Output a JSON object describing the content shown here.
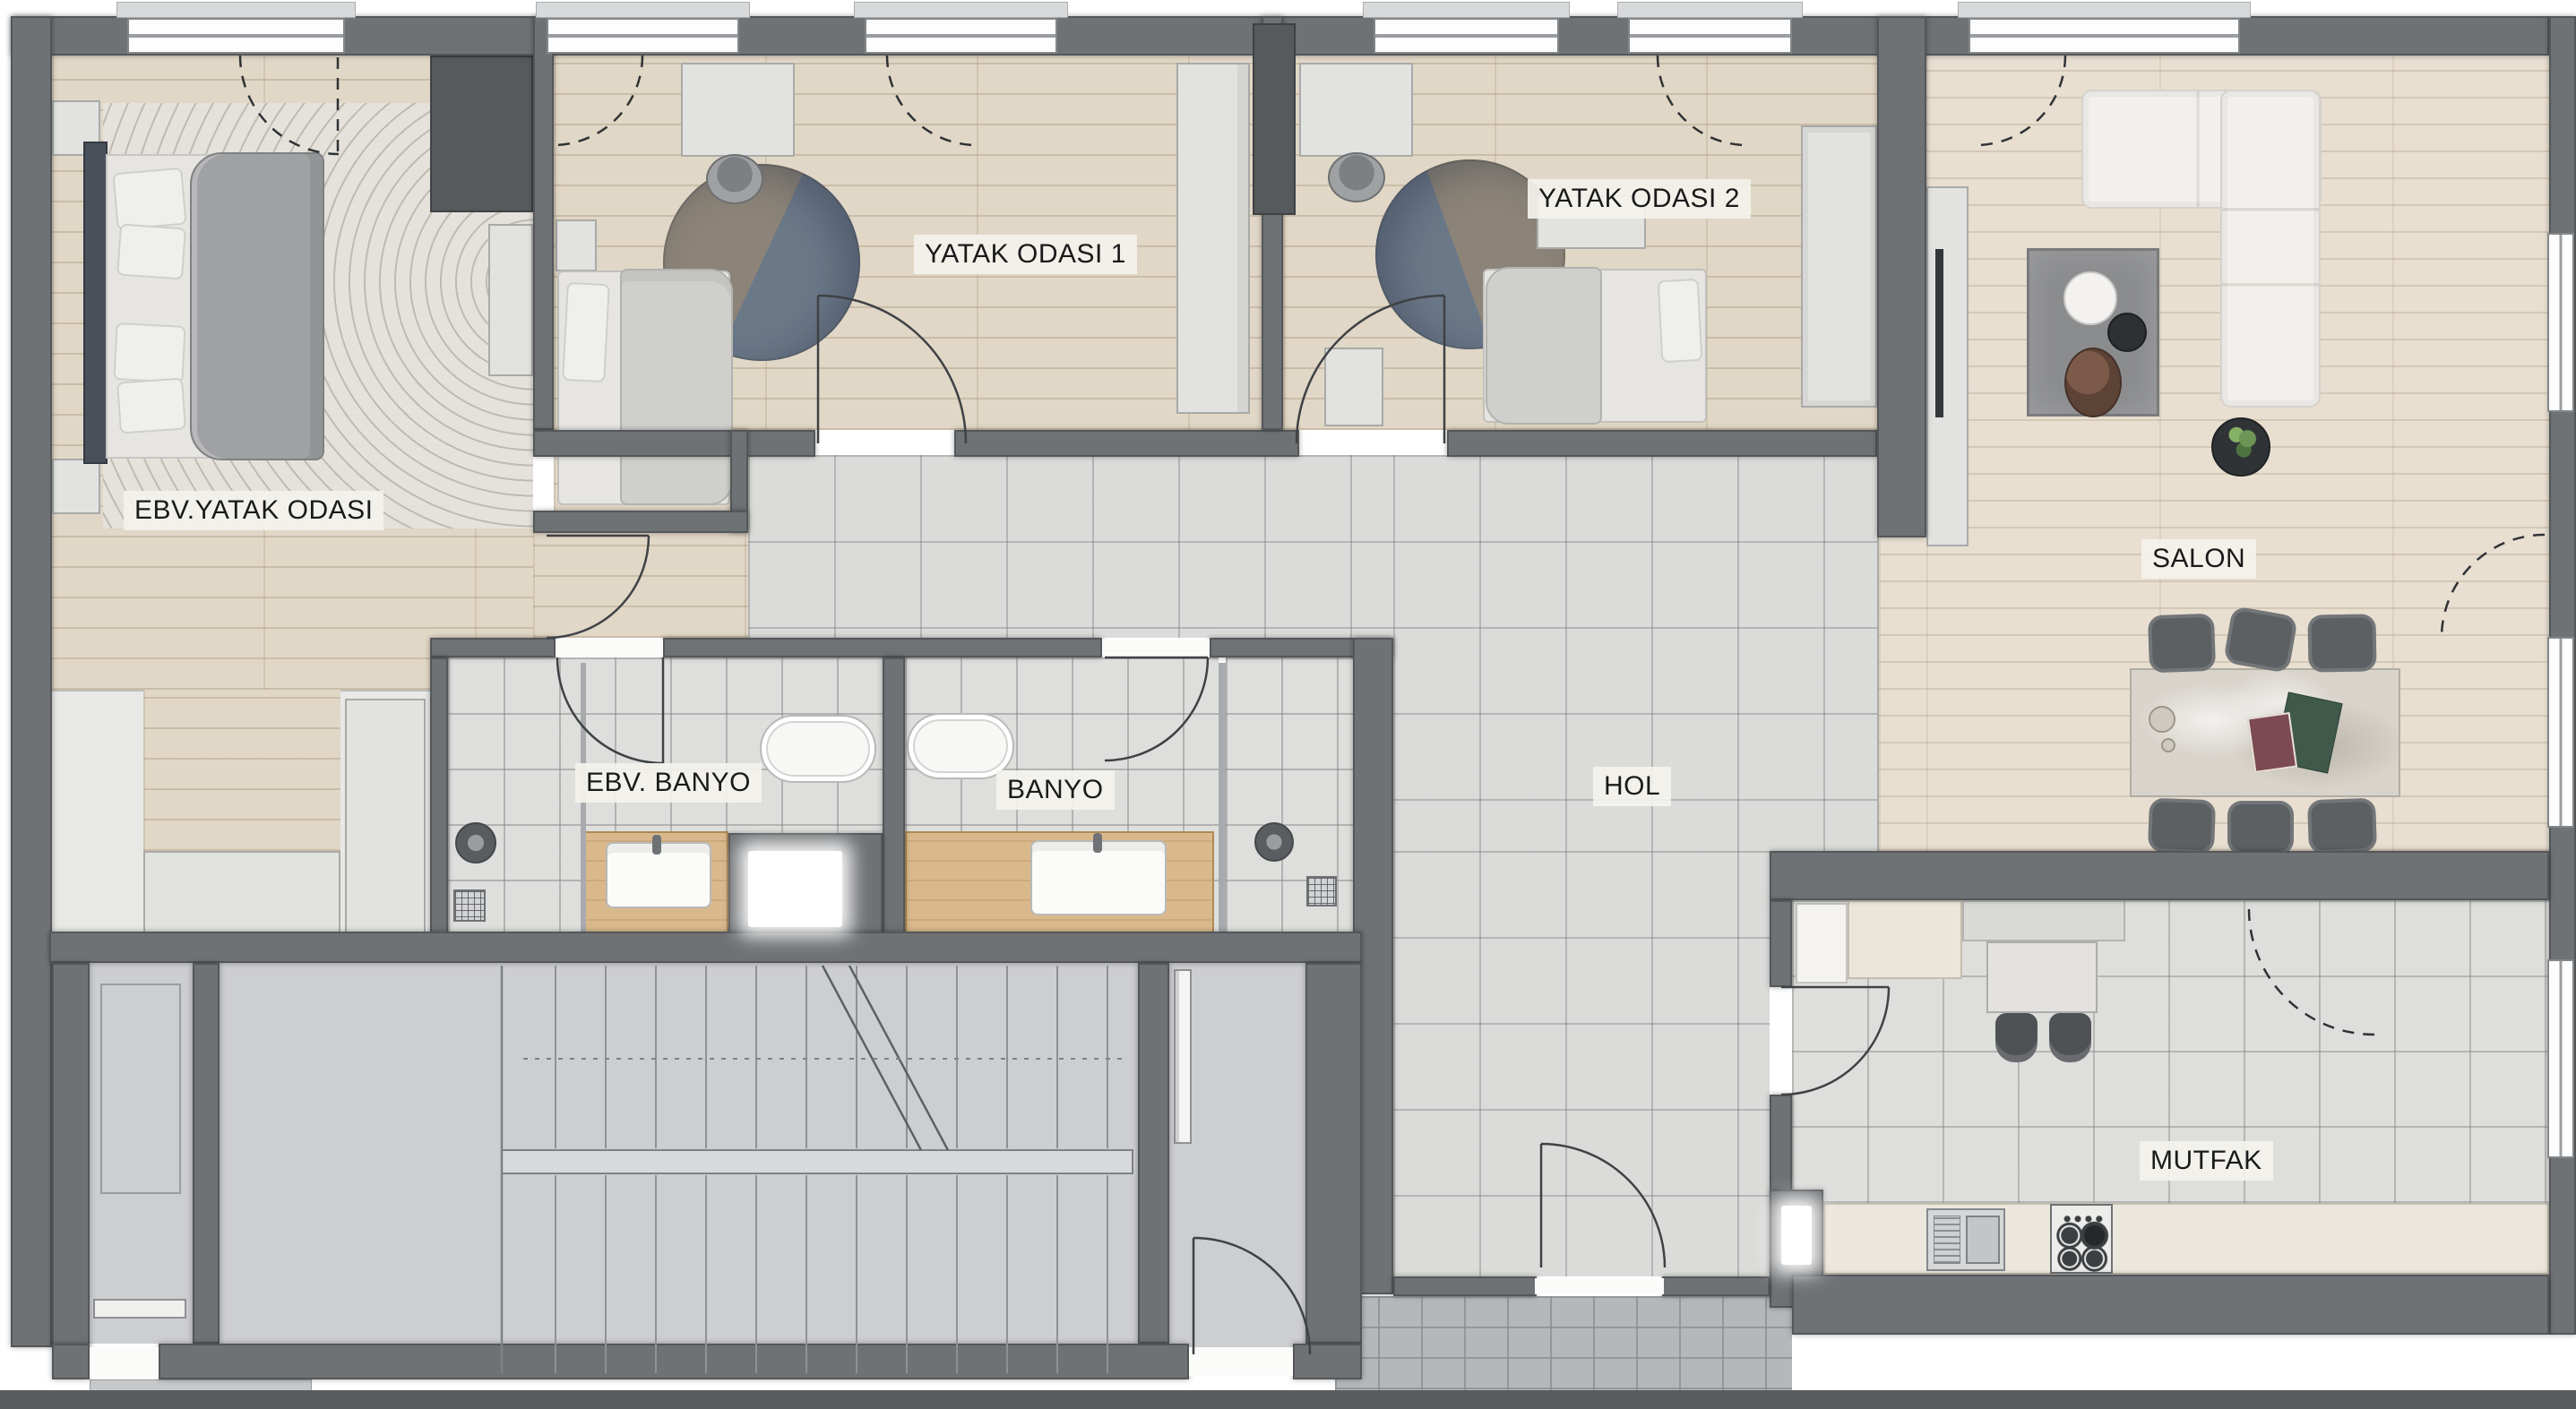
{
  "document": {
    "type": "architectural floor plan",
    "language": "tr"
  },
  "rooms": [
    {
      "id": "ebv-yatak-odasi",
      "label": "EBV.YATAK ODASI"
    },
    {
      "id": "yatak-odasi-1",
      "label": "YATAK ODASI 1"
    },
    {
      "id": "yatak-odasi-2",
      "label": "YATAK ODASI 2"
    },
    {
      "id": "salon",
      "label": "SALON"
    },
    {
      "id": "ebv-banyo",
      "label": "EBV. BANYO"
    },
    {
      "id": "banyo",
      "label": "BANYO"
    },
    {
      "id": "hol",
      "label": "HOL"
    },
    {
      "id": "mutfak",
      "label": "MUTFAK"
    }
  ],
  "colors": {
    "wall": "#6f7275",
    "wall_outline": "#54575a",
    "wood_floor": "#e1d7c6",
    "tile_floor": "#dcdddb",
    "vanity_wood": "#d9b98c",
    "label_bg": "#f4f2ed",
    "label_text": "#1a1a1a",
    "sofa": "#f2f0ed",
    "dark_furniture": "#575a5d"
  }
}
